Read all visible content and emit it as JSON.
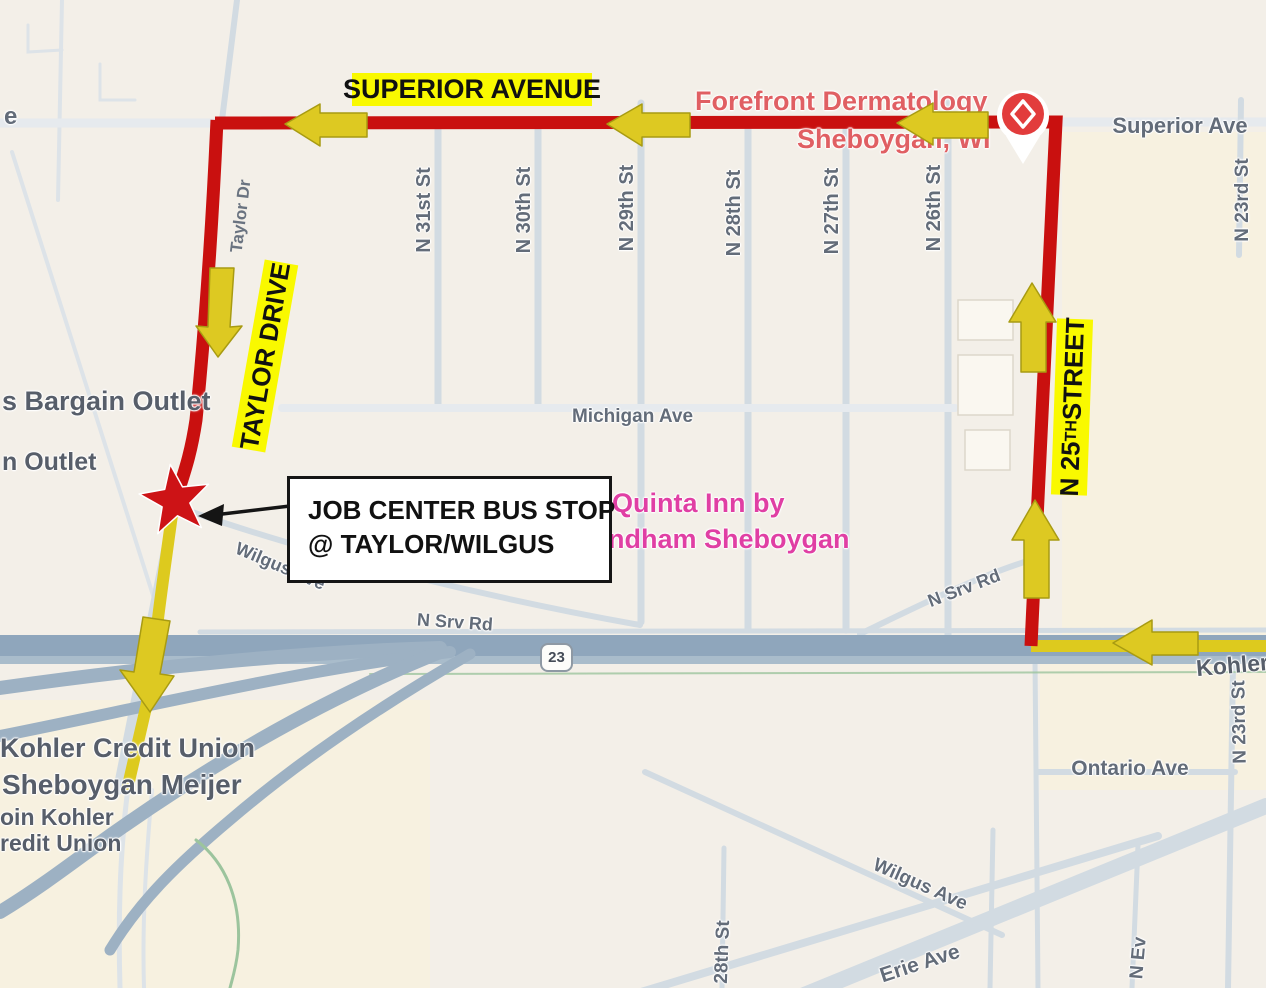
{
  "map": {
    "highlight_labels": {
      "superior_avenue": "SUPERIOR AVENUE",
      "taylor_drive": "TAYLOR DRIVE",
      "n25_prefix": "N 25",
      "n25_sup": "TH",
      "n25_suffix": " STREET"
    },
    "callout": {
      "line1": "JOB CENTER BUS STOP",
      "line2": "@ TAYLOR/WILGUS"
    },
    "poi": {
      "forefront_line1": "Forefront Dermatology",
      "forefront_line2": "Sheboygan, WI",
      "quinta_line1": "Quinta Inn by",
      "quinta_line2": "ndham Sheboygan",
      "bargain_outlet": "s Bargain Outlet",
      "outlet_small": "n Outlet",
      "kohler_credit_union": "Kohler Credit Union",
      "sheboygan_meijer": "Sheboygan Meijer",
      "join_kohler_cut": "oin Kohler",
      "credit_union_cut": "redit Union"
    },
    "streets": {
      "superior_ave": "Superior Ave",
      "michigan_ave": "Michigan Ave",
      "ontario_ave": "Ontario Ave",
      "wilgus_ave": "Wilgus Ave",
      "wilgus_ave2": "Wilgus Ave",
      "erie_ave": "Erie Ave",
      "n_srv_rd": "N Srv Rd",
      "n_srv_rd2": "N Srv Rd",
      "kohler": "Kohler",
      "taylor_dr": "Taylor Dr",
      "n31": "N 31st St",
      "n30": "N 30th St",
      "n29": "N 29th St",
      "n28": "N 28th St",
      "n27": "N 27th St",
      "n26": "N 26th St",
      "n23_top": "N 23rd St",
      "n23_bottom": "N 23rd St",
      "n28_bottom": "28th St",
      "n_ev": "N Ev",
      "left_edge": "e"
    },
    "highway_shield": "23",
    "colors": {
      "route_red": "#c9100f",
      "route_yellow": "#ddca1e",
      "arrow_yellow": "#ddc922",
      "arrow_edge": "#a89b12",
      "highlight_yellow": "#f9f900",
      "star_red": "#cd1316",
      "pin_red": "#e23c3c",
      "poi_red": "#e05f63",
      "poi_pink": "#e03fa4",
      "label_gray": "#636c79",
      "dark_gray": "#575e6a"
    }
  }
}
